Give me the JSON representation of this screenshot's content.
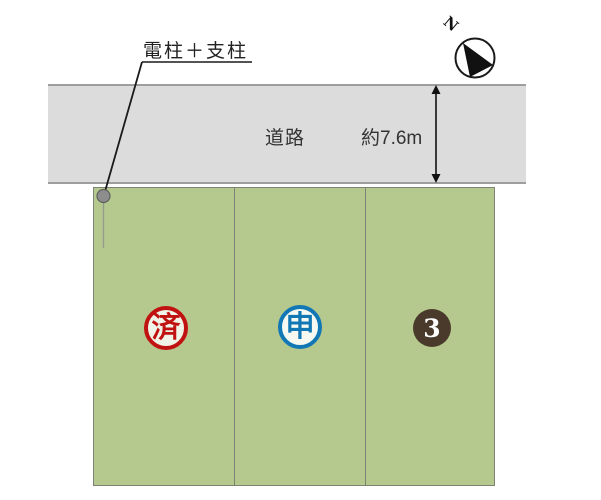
{
  "canvas": {
    "width": 601,
    "height": 500,
    "background": "#ffffff"
  },
  "annotation": {
    "pole_label": "電柱＋支柱"
  },
  "compass": {
    "label": "N"
  },
  "road": {
    "label": "道路",
    "width_label": "約7.6m",
    "fill": "#dcdcdc",
    "border_color": "#9e9e9e"
  },
  "plots": {
    "fill": "#b5c98e",
    "border_color": "#7d8274",
    "items": [
      {
        "id": "lot-1",
        "badge": {
          "style": "stamp",
          "text": "済",
          "color": "#c11212"
        }
      },
      {
        "id": "lot-2",
        "badge": {
          "style": "stamp",
          "text": "申",
          "color": "#1277b5"
        }
      },
      {
        "id": "lot-3",
        "badge": {
          "style": "filled-number",
          "text": "3",
          "color": "#493a2b",
          "text_color": "#ffffff"
        }
      }
    ]
  }
}
